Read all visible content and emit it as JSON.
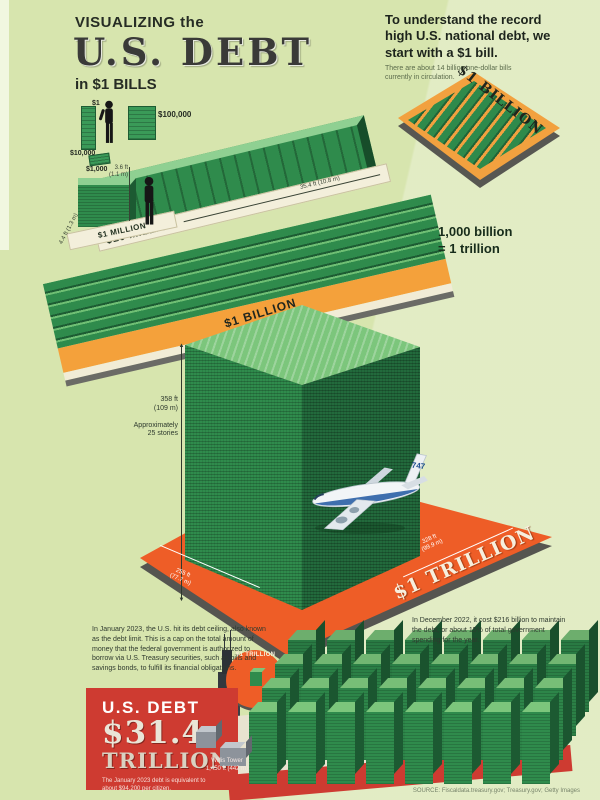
{
  "header": {
    "kicker": "VISUALIZING the",
    "title": "U.S. DEBT",
    "subtitle": "in $1 BILLS"
  },
  "intro": {
    "lead": "To understand the record high U.S. national debt, we start with a $1 bill.",
    "note": "There are about 14 billion one-dollar bills currently in circulation."
  },
  "scale": {
    "dollar": "$1",
    "thousand": "$1,000",
    "ten_thousand": "$10,000",
    "hundred_thousand": "$100,000",
    "stack_height_ft": "3.6 ft",
    "stack_height_m": "(1.1 m)",
    "million": "$1 MILLION",
    "million_size": "4.4 ft (1.3 m)",
    "ten_million": "$10 MILLION",
    "ten_million_length": "35.4 ft (10.8 m)"
  },
  "billion": {
    "label": "$1 BILLION",
    "equation_line1": "1,000 billion",
    "equation_line2": "= 1 trillion"
  },
  "trillion": {
    "label": "$1 TRILLION",
    "height_ft": "358 ft",
    "height_m": "(109 m)",
    "stories_line1": "Approximately",
    "stories_line2": "25 stories",
    "width": "328 ft",
    "width_m": "(99.9 m)",
    "depth": "255 ft",
    "depth_m": "(77.7 m)",
    "plane_label": "747",
    "callout_label": "$1 TRILLION"
  },
  "footer": {
    "left_note": "In January 2023, the U.S. hit its debt ceiling, also known as the debt limit. This is a cap on the total amount of money that the federal government is authorized to borrow via U.S. Treasury securities, such as bills and savings bonds, to fulfill its financial obligations.",
    "debt_kicker": "U.S. DEBT",
    "debt_value": "$31.4",
    "debt_unit": "TRILLION",
    "per_citizen": "The January 2023 debt is equivalent to about $94,200 per citizen.",
    "tower_name": "Willis Tower",
    "tower_height": "1,450 ft (442 m)",
    "right_note": "In December 2022, it cost $216 billion to maintain the debt, or about 15% of total government spending for the year.",
    "credit": "SOURCE: Fiscaldata.treasury.gov; Treasury.gov; Getty Images"
  },
  "bottom_stack": {
    "rows": 4,
    "per_row": 8
  }
}
